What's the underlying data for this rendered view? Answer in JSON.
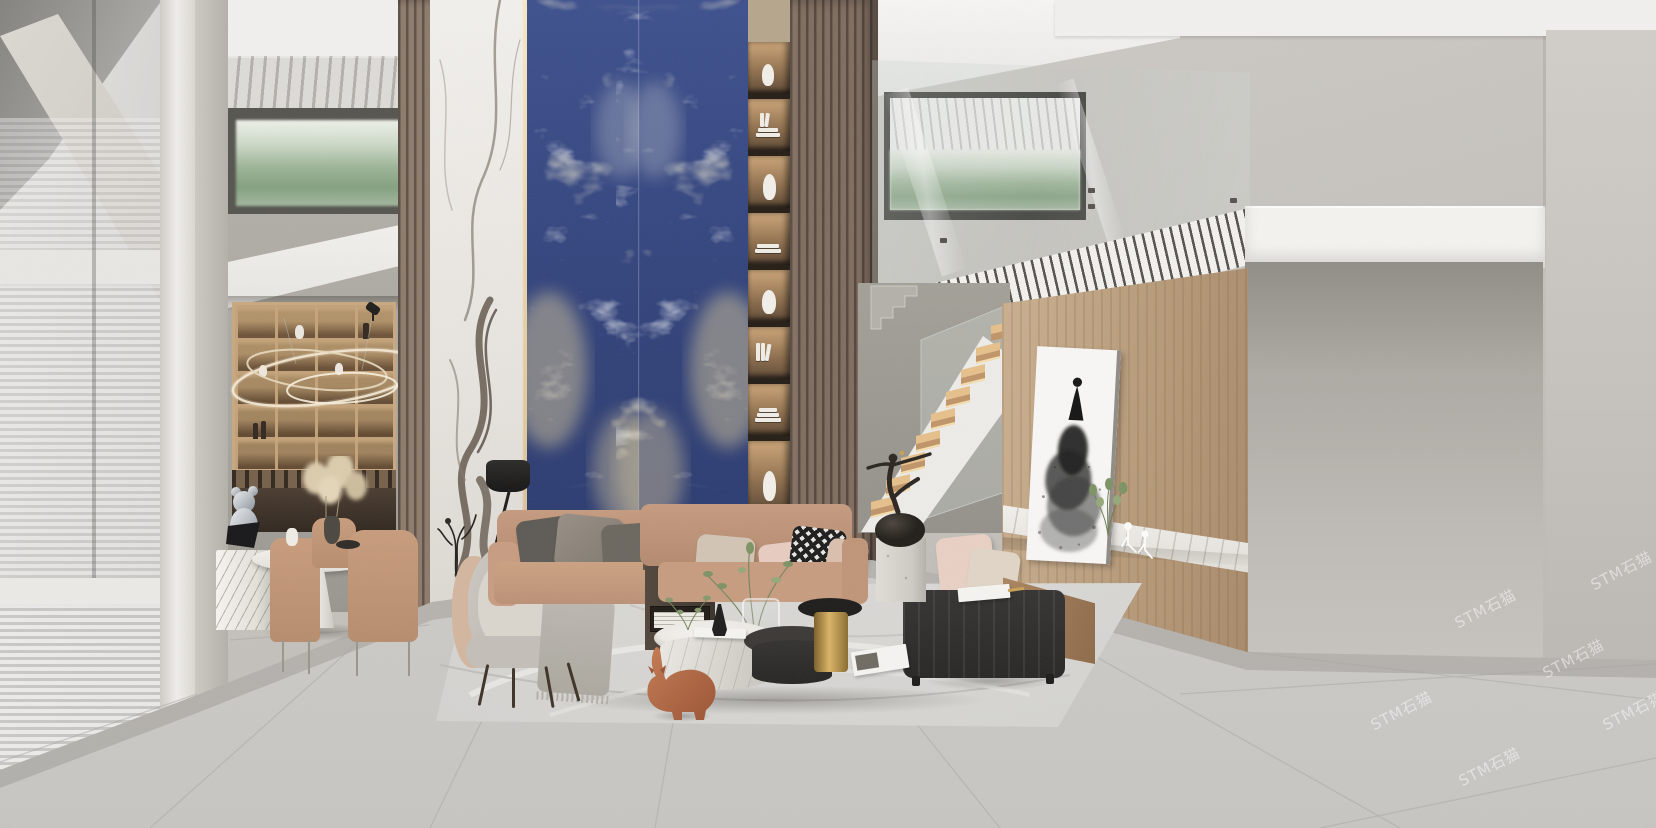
{
  "watermark": {
    "text": "STM石猫"
  },
  "scene": {
    "type": "photorealistic 3D interior render",
    "room": "double-height luxury living room showroom with mezzanine",
    "description": "Modern showroom interior: bookmatched blue sodalite marble feature wall flanked by white Calacatta marble panel and walnut wood-slat columns, backlit bookshelf niche, floating stair with lit oak treads and glass guard, mezzanine with glass balustrade and louvered slab fascia, oak feature wall with floating marble console shelf and ink-dress artwork, tan leather modular sofa group, black leather bench, round marble coffee tables, grey lounge chair, dining nook with backlit display cabinet and ring chandelier, large-format grey marble tile floor with area rug and terracotta cat sculpture"
  },
  "palette": {
    "blue_marble": "#35477f",
    "blue_marble_vein_cream": "#d6c69a",
    "blue_marble_vein_navy": "#1a2450",
    "white_marble": "#f0eeea",
    "marble_vein_dark": "#56493c",
    "wood_slat": "#8d7a6b",
    "wood_slat_gap": "#5e5046",
    "oak_wall": "#bca07f",
    "sofa_leather": "#c09579",
    "blush_pillow": "#e7ccc0",
    "houndstooth": "#1d1d1d",
    "bench_leather": "#2b2a29",
    "stair_tread": "#e6c08b",
    "shelf_glow": "#cda578",
    "wall": "#c7c4bf",
    "floor": "#d5d3cf",
    "rug": "#d8d7d4",
    "cat_sculpture": "#b06046",
    "gold_accent": "#c9a254",
    "hills_view": "#9cb496",
    "painting_ink": "#1a1a1a",
    "glass_tint": "#cfd8d4"
  },
  "bookshelf": {
    "items": [
      "vase",
      "books",
      "bust",
      "books",
      "vase",
      "books",
      "books",
      "vase"
    ]
  },
  "objects": [
    "left-window-wall",
    "window-blinds",
    "concrete-pilaster",
    "dining-display-cabinet",
    "ring-chandelier",
    "dining-table",
    "dining-chairs",
    "marble-plinth",
    "chrome-figure-sculpture",
    "pampas-arrangement",
    "wood-slat-column",
    "calacatta-marble-panel",
    "led-light-gap",
    "blue-sodalite-marble-wall",
    "backlit-bookshelf",
    "mezzanine-window",
    "glass-balustrade",
    "louvered-fascia",
    "mezzanine-slab",
    "staircase",
    "stair-glass-guard",
    "ink-dress-painting",
    "oak-feature-wall",
    "marble-console-shelf",
    "wire-figurines",
    "potted-plant",
    "floor-lamp",
    "twig-decor",
    "lounge-chair",
    "throw-blanket",
    "leather-sofa",
    "scatter-pillows",
    "houndstooth-pillow",
    "wood-side-console",
    "marble-coffee-table",
    "charcoal-coffee-table",
    "gold-side-table",
    "glass-vase",
    "greenery",
    "black-leather-bench",
    "bench-wood-backrest",
    "magazine",
    "area-rug",
    "cat-sculpture",
    "bronze-sculpture",
    "stone-plinth",
    "tile-floor",
    "watermark"
  ]
}
